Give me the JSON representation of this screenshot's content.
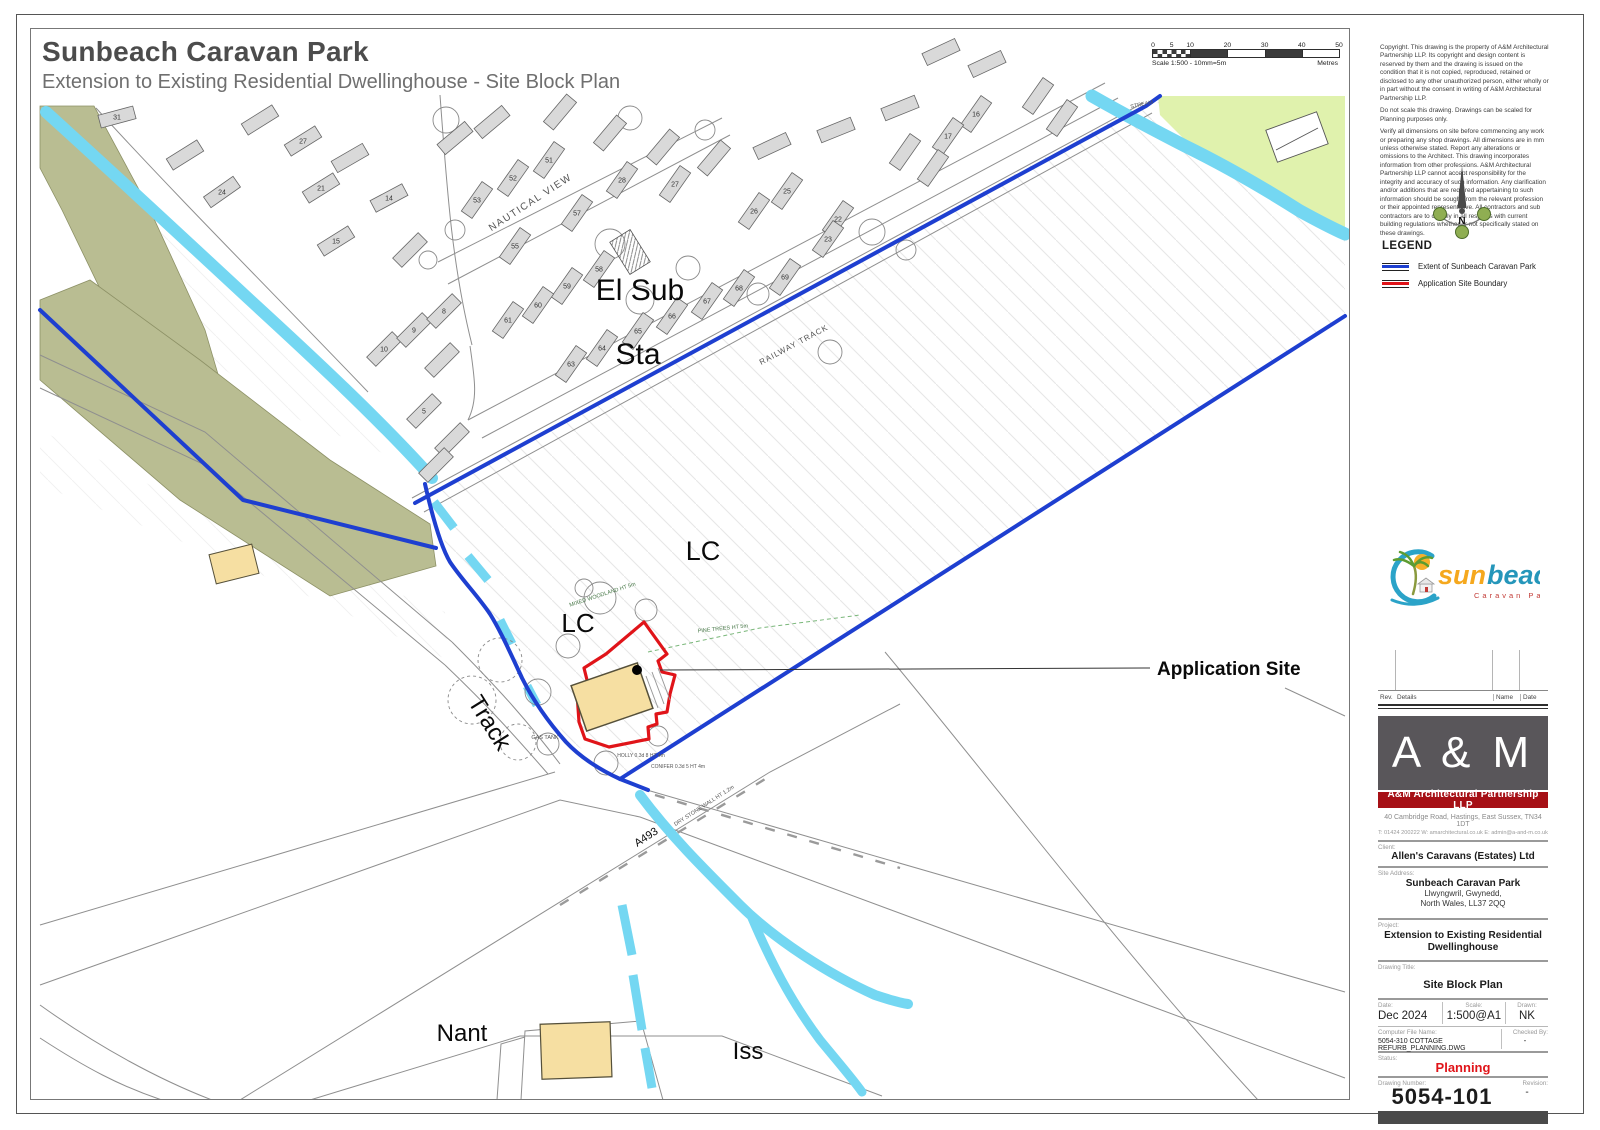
{
  "page": {
    "title": "Sunbeach Caravan Park",
    "subtitle": "Extension to Existing Residential Dwellinghouse - Site Block Plan"
  },
  "scale_bar": {
    "caption": "Scale 1:500   -   10mm=5m",
    "unit": "Metres",
    "ticks": [
      0,
      5,
      10,
      20,
      30,
      40,
      50
    ]
  },
  "notes": {
    "para1": "Copyright. This drawing is the property of A&M Architectural Partnership LLP. Its copyright and design content is reserved by them and the drawing is issued on the condition that it is not copied, reproduced, retained or disclosed to any other unauthorized person, either wholly or in part without the consent in writing of A&M Architectural Partnership LLP.",
    "para2": "Do not scale this drawing. Drawings can be scaled for Planning purposes only.",
    "para3": "Verify all dimensions on site before commencing any work or preparing any shop drawings. All dimensions are in mm unless otherwise stated. Report any alterations or omissions to the Architect. This drawing incorporates information from other professions. A&M Architectural Partnership LLP cannot accept responsibility for the integrity and accuracy of such information. Any clarification and/or additions that are required appertaining to such information should be sought from the relevant profession or their appointed representative. All contractors and sub contractors are to comply in all respects with current building regulations whether or not specifically stated on these drawings."
  },
  "compass": {
    "letter": "N"
  },
  "legend": {
    "title": "LEGEND",
    "items": [
      {
        "label": "Extent of Sunbeach Caravan Park",
        "color": "#1e3fd0"
      },
      {
        "label": "Application Site Boundary",
        "color": "#e01419"
      }
    ]
  },
  "logo": {
    "sun": "sun",
    "beach": "beach",
    "tagline": "Caravan Park"
  },
  "rev_table": {
    "headers": [
      "Rev.",
      "Details",
      "Name",
      "Date"
    ]
  },
  "firm": {
    "initials": "A & M",
    "name": "A&M Architectural Partnership LLP",
    "address": "40 Cambridge Road, Hastings, East Sussex, TN34 1DT",
    "contact": "T: 01424 200222    W: amarchitectural.co.uk    E: admin@a-and-m.co.uk"
  },
  "titleblock": {
    "client_label": "Client:",
    "client": "Allen's Caravans (Estates) Ltd",
    "site_label": "Site Address:",
    "site_name": "Sunbeach Caravan Park",
    "site_line2": "Llwyngwril, Gwynedd,",
    "site_line3": "North Wales, LL37 2QQ",
    "project_label": "Project:",
    "project": "Extension to Existing Residential Dwellinghouse",
    "drawing_title_label": "Drawing Title:",
    "drawing_title": "Site Block Plan",
    "date_label": "Date:",
    "date": "Dec 2024",
    "scale_label": "Scale:",
    "scale": "1:500@A1",
    "drawn_label": "Drawn:",
    "drawn": "NK",
    "file_label": "Computer File Name:",
    "file": "5054-310  COTTAGE REFURB_PLANNING.DWG",
    "checked_label": "Checked By:",
    "checked": "-",
    "status_label": "Status:",
    "status": "Planning",
    "number_label": "Drawing Number:",
    "number": "5054-101",
    "revision_label": "Revision:",
    "revision": "-"
  },
  "map": {
    "labels": [
      {
        "text": "El Sub",
        "x": 640,
        "y": 300,
        "s": 30
      },
      {
        "text": "Sta",
        "x": 638,
        "y": 364,
        "s": 30
      },
      {
        "text": "LC",
        "x": 703,
        "y": 560,
        "s": 27
      },
      {
        "text": "LC",
        "x": 578,
        "y": 632,
        "s": 26
      },
      {
        "text": "Track",
        "x": 483,
        "y": 727,
        "s": 24,
        "r": 58
      },
      {
        "text": "Application Site",
        "x": 1157,
        "y": 675,
        "s": 19,
        "b": 1,
        "a": "start"
      },
      {
        "text": "Nant",
        "x": 462,
        "y": 1041,
        "s": 24
      },
      {
        "text": "Iss",
        "x": 748,
        "y": 1059,
        "s": 24
      },
      {
        "text": "A493",
        "x": 648,
        "y": 840,
        "s": 11,
        "r": -33
      },
      {
        "text": "NAUTICAL  VIEW",
        "x": 532,
        "y": 205,
        "s": 10,
        "r": -33,
        "c": "#555",
        "ls": 1.5
      },
      {
        "text": "RAILWAY  TRACK",
        "x": 795,
        "y": 347,
        "s": 8,
        "r": -28,
        "c": "#555",
        "ls": 1
      },
      {
        "text": "GAS TANK",
        "x": 545,
        "y": 739,
        "s": 5.5,
        "c": "#555"
      },
      {
        "text": "DRY STONE WALL  HT 1.2m",
        "x": 705,
        "y": 807,
        "s": 5.5,
        "r": -33,
        "c": "#555"
      },
      {
        "text": "MIXED WOODLAND  HT 5m",
        "x": 603,
        "y": 596,
        "s": 5.5,
        "r": -18,
        "c": "#4a7a4a"
      },
      {
        "text": "PINE TREES  HT 5m",
        "x": 723,
        "y": 630,
        "s": 5.5,
        "r": -6,
        "c": "#4a7a4a"
      },
      {
        "text": "HOLLY 0.3d 8 HT 4m",
        "x": 641,
        "y": 757,
        "s": 5,
        "c": "#555"
      },
      {
        "text": "CONIFER 0.3d 5 HT 4m",
        "x": 678,
        "y": 768,
        "s": 5,
        "c": "#555"
      },
      {
        "text": "STREAM",
        "x": 1142,
        "y": 106,
        "s": 5.5,
        "r": -12,
        "c": "#555"
      }
    ],
    "plots": [
      {
        "n": "31",
        "x": 117,
        "y": 117,
        "r": -15
      },
      {
        "n": "27",
        "x": 303,
        "y": 141,
        "r": -32
      },
      {
        "n": "24",
        "x": 222,
        "y": 192,
        "r": -35
      },
      {
        "n": "21",
        "x": 321,
        "y": 188,
        "r": -32
      },
      {
        "n": "14",
        "x": 389,
        "y": 198,
        "r": -28
      },
      {
        "n": "15",
        "x": 336,
        "y": 241,
        "r": -32
      },
      {
        "n": "16",
        "x": 976,
        "y": 114,
        "r": -55
      },
      {
        "n": "17",
        "x": 948,
        "y": 136,
        "r": -55
      },
      {
        "n": "10",
        "x": 384,
        "y": 349,
        "r": -45
      },
      {
        "n": "9",
        "x": 414,
        "y": 330,
        "r": -45
      },
      {
        "n": "8",
        "x": 444,
        "y": 311,
        "r": -45
      },
      {
        "n": "5",
        "x": 424,
        "y": 411,
        "r": -45
      },
      {
        "n": "51",
        "x": 549,
        "y": 160,
        "r": -55
      },
      {
        "n": "52",
        "x": 513,
        "y": 178,
        "r": -55
      },
      {
        "n": "53",
        "x": 477,
        "y": 200,
        "r": -55
      },
      {
        "n": "55",
        "x": 515,
        "y": 246,
        "r": -55
      },
      {
        "n": "57",
        "x": 577,
        "y": 213,
        "r": -55
      },
      {
        "n": "28",
        "x": 622,
        "y": 180,
        "r": -55
      },
      {
        "n": "27",
        "x": 675,
        "y": 184,
        "r": -55
      },
      {
        "n": "26",
        "x": 754,
        "y": 211,
        "r": -55
      },
      {
        "n": "25",
        "x": 787,
        "y": 191,
        "r": -55
      },
      {
        "n": "22",
        "x": 838,
        "y": 219,
        "r": -55
      },
      {
        "n": "23",
        "x": 828,
        "y": 239,
        "r": -55
      },
      {
        "n": "58",
        "x": 599,
        "y": 269,
        "r": -55
      },
      {
        "n": "59",
        "x": 567,
        "y": 286,
        "r": -55
      },
      {
        "n": "60",
        "x": 538,
        "y": 305,
        "r": -55
      },
      {
        "n": "61",
        "x": 508,
        "y": 320,
        "r": -55
      },
      {
        "n": "63",
        "x": 571,
        "y": 364,
        "r": -55
      },
      {
        "n": "64",
        "x": 602,
        "y": 348,
        "r": -55
      },
      {
        "n": "65",
        "x": 638,
        "y": 331,
        "r": -55
      },
      {
        "n": "66",
        "x": 672,
        "y": 316,
        "r": -55
      },
      {
        "n": "67",
        "x": 707,
        "y": 301,
        "r": -55
      },
      {
        "n": "68",
        "x": 739,
        "y": 288,
        "r": -55
      },
      {
        "n": "69",
        "x": 785,
        "y": 277,
        "r": -55
      },
      {
        "x": 455,
        "y": 138,
        "r": -40
      },
      {
        "x": 492,
        "y": 122,
        "r": -40
      },
      {
        "x": 560,
        "y": 112,
        "r": -50
      },
      {
        "x": 610,
        "y": 133,
        "r": -50
      },
      {
        "x": 663,
        "y": 147,
        "r": -50
      },
      {
        "x": 714,
        "y": 158,
        "r": -50
      },
      {
        "x": 772,
        "y": 146,
        "r": -25
      },
      {
        "x": 836,
        "y": 130,
        "r": -22
      },
      {
        "x": 900,
        "y": 108,
        "r": -22
      },
      {
        "x": 941,
        "y": 52,
        "r": -25
      },
      {
        "x": 987,
        "y": 64,
        "r": -25
      },
      {
        "x": 1038,
        "y": 96,
        "r": -55
      },
      {
        "x": 1062,
        "y": 118,
        "r": -55
      },
      {
        "x": 905,
        "y": 152,
        "r": -55
      },
      {
        "x": 933,
        "y": 168,
        "r": -55
      },
      {
        "x": 260,
        "y": 120,
        "r": -32
      },
      {
        "x": 185,
        "y": 155,
        "r": -32
      },
      {
        "x": 350,
        "y": 158,
        "r": -30
      },
      {
        "x": 410,
        "y": 250,
        "r": -45
      },
      {
        "x": 442,
        "y": 360,
        "r": -45
      },
      {
        "x": 452,
        "y": 440,
        "r": -45
      },
      {
        "x": 436,
        "y": 465,
        "r": -45
      }
    ]
  }
}
